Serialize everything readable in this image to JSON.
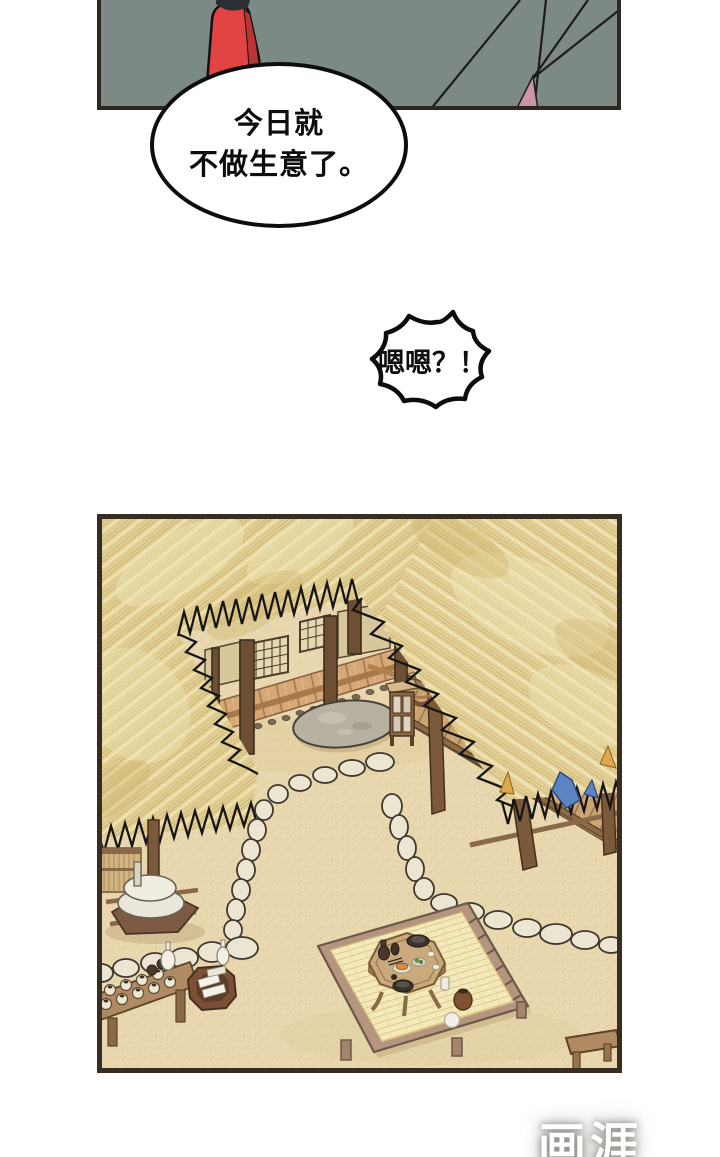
{
  "page": {
    "width": 720,
    "height": 1157,
    "background": "#ffffff"
  },
  "top_panel": {
    "name": "street-scene-panel",
    "background_color": "#7d8985",
    "border_color": "#2d2722",
    "figure": {
      "name": "person-in-red-robe",
      "robe_color": "#e24444",
      "robe_shade_color": "#ba3434",
      "hair_color": "#2b3034"
    },
    "pole_line_color": "#1c1c1c",
    "pink_cloth_color": "#c993a8"
  },
  "speech_bubbles": {
    "oval": {
      "line1": "今日就",
      "line2": "不做生意了。",
      "fill": "#ffffff",
      "border": "#0d0d0d"
    },
    "spiky": {
      "text": "嗯嗯？！",
      "fill": "#ffffff",
      "border": "#0d0d0d"
    }
  },
  "scene_panel": {
    "name": "thatched-courtyard-scene",
    "border_color": "#372d22",
    "ground_color": "#e9d8af",
    "thatch_color": "#e3d096",
    "thatch_streak_dark": "#c9b26c",
    "thatch_streak_light": "#f2e7bd",
    "fringe_color": "#161616",
    "wood_light": "#d6a877",
    "wood_mid": "#9a7a58",
    "wood_dark": "#6e4f33",
    "stone_color": "#ece5d2",
    "stepping_stone_color": "#b7b1a2",
    "mat_color": "#f4e9ba",
    "blue_cloth_color": "#5b84c4",
    "elements": [
      "thatched-roof-left",
      "thatched-roof-right",
      "porch-house",
      "lattice-window",
      "stepping-stone",
      "lantern-stand",
      "barrel",
      "stone-path",
      "hanging-basket",
      "millstone",
      "jar-table",
      "paper-bucket",
      "wooden-platform",
      "straw-mat",
      "tea-table",
      "tea-set",
      "wooden-railing",
      "blue-cloth",
      "small-stool"
    ]
  },
  "watermark": {
    "text": "画涯",
    "color": "#ffffff"
  }
}
